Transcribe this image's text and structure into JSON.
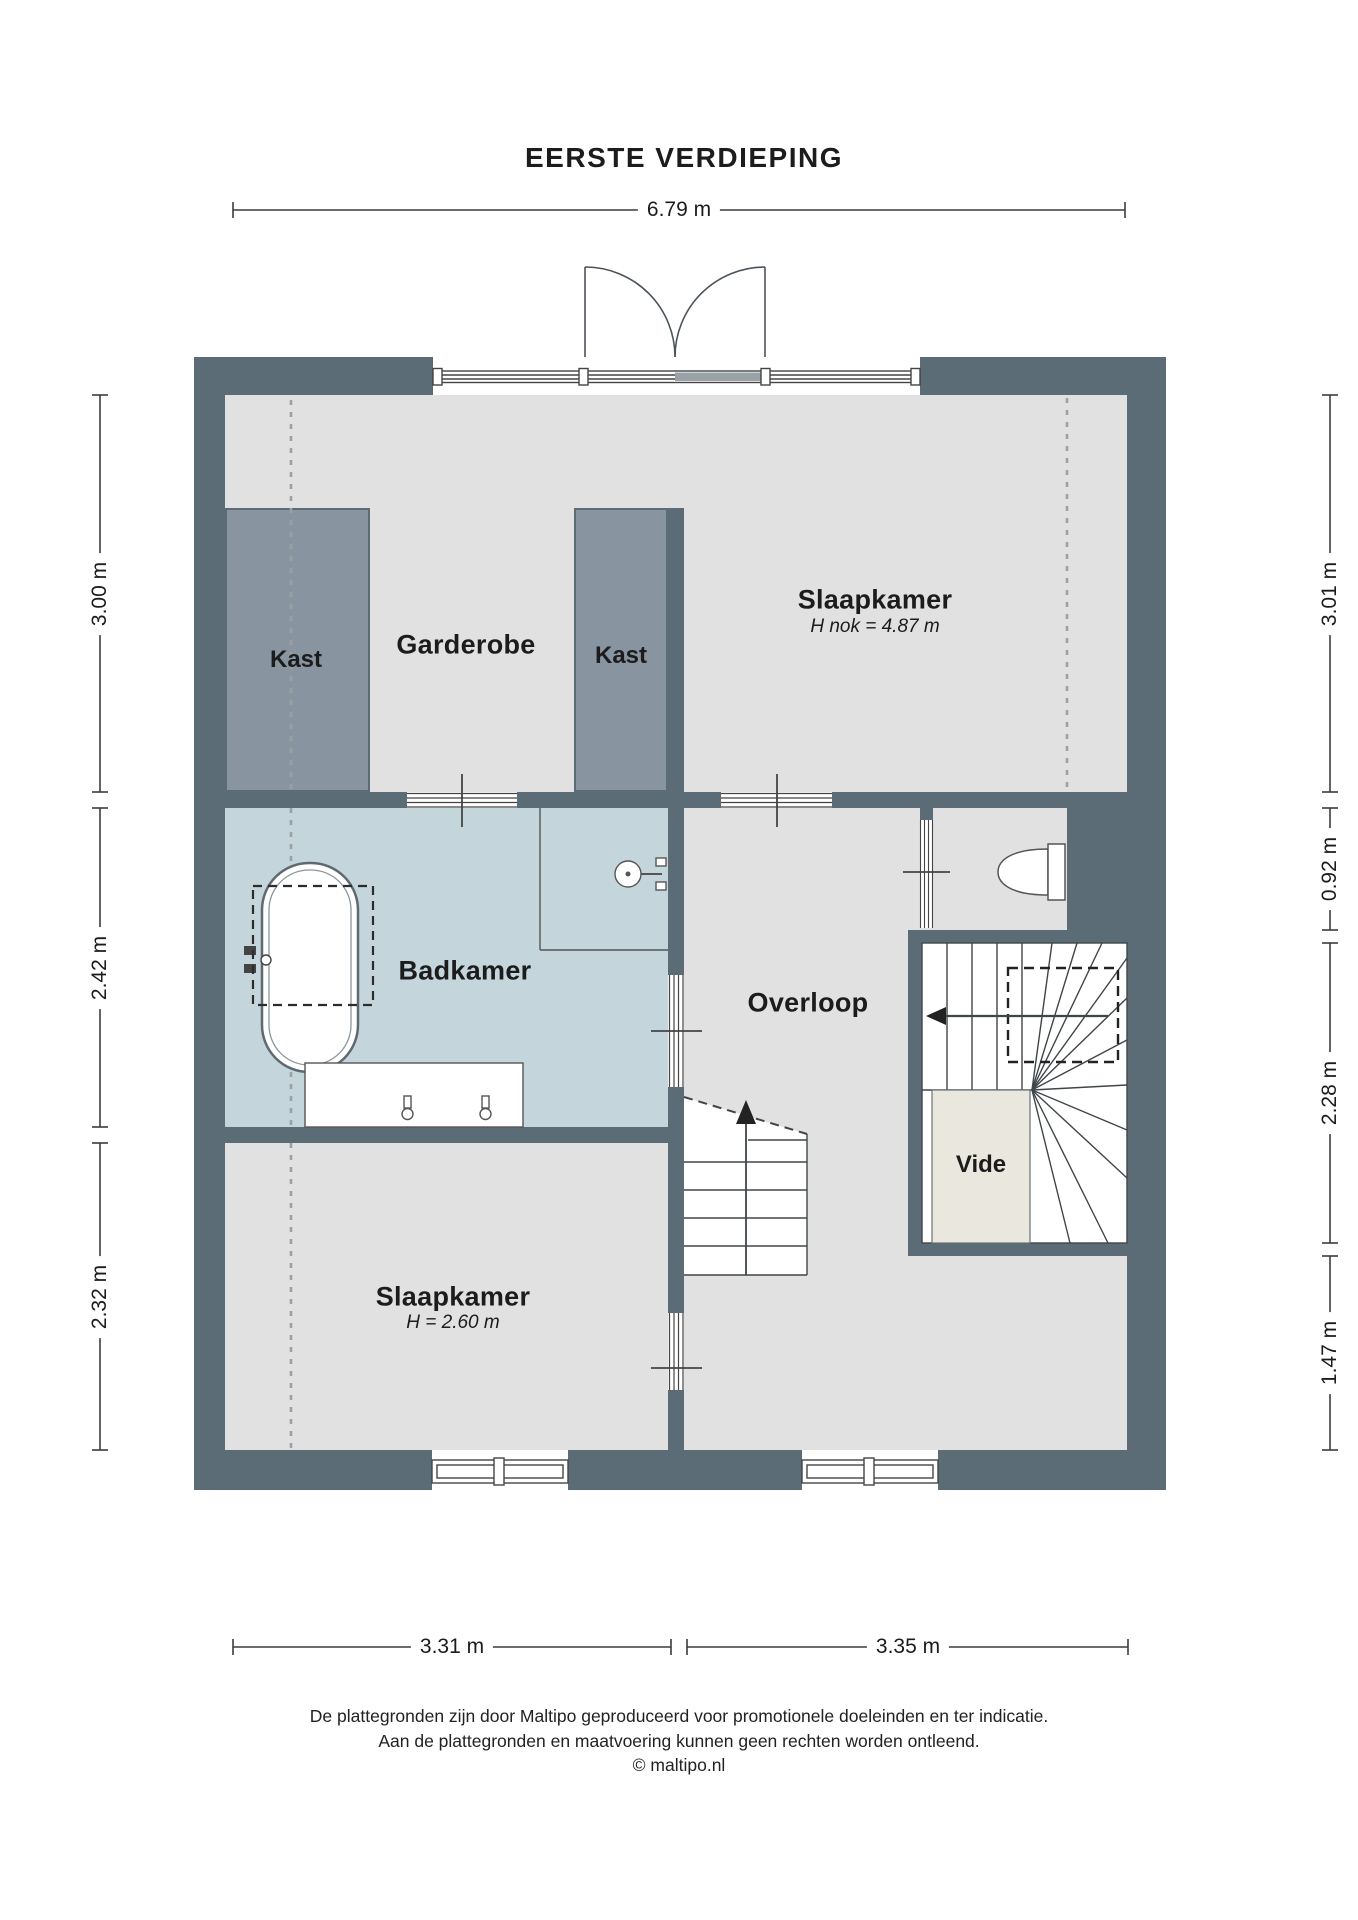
{
  "title": "EERSTE VERDIEPING",
  "dimensions": {
    "top": "6.79 m",
    "left": [
      "3.00 m",
      "2.42 m",
      "2.32 m"
    ],
    "right": [
      "3.01 m",
      "0.92 m",
      "2.28 m",
      "1.47 m"
    ],
    "bottom": [
      "3.31 m",
      "3.35 m"
    ]
  },
  "rooms": {
    "slaapkamer_top": {
      "name": "Slaapkamer",
      "height_note": "H nok = 4.87 m"
    },
    "garderobe": {
      "name": "Garderobe"
    },
    "kast_left": {
      "name": "Kast"
    },
    "kast_right": {
      "name": "Kast"
    },
    "badkamer": {
      "name": "Badkamer"
    },
    "overloop": {
      "name": "Overloop"
    },
    "vide": {
      "name": "Vide"
    },
    "slaapkamer_bottom": {
      "name": "Slaapkamer",
      "height_note": "H = 2.60 m"
    }
  },
  "footer": {
    "disclaimer_line1": "De plattegronden zijn door Maltipo geproduceerd voor promotionele doeleinden en ter indicatie.",
    "disclaimer_line2": "Aan de plattegronden en maatvoering kunnen geen rechten worden ontleend.",
    "copyright": "© maltipo.nl"
  },
  "colors": {
    "wall": "#5b6c77",
    "closet_fill": "#88949f",
    "floor": "#e1e1e2",
    "wet_floor": "#c4d5db",
    "vide_floor": "#eae7df",
    "line": "#444444"
  }
}
